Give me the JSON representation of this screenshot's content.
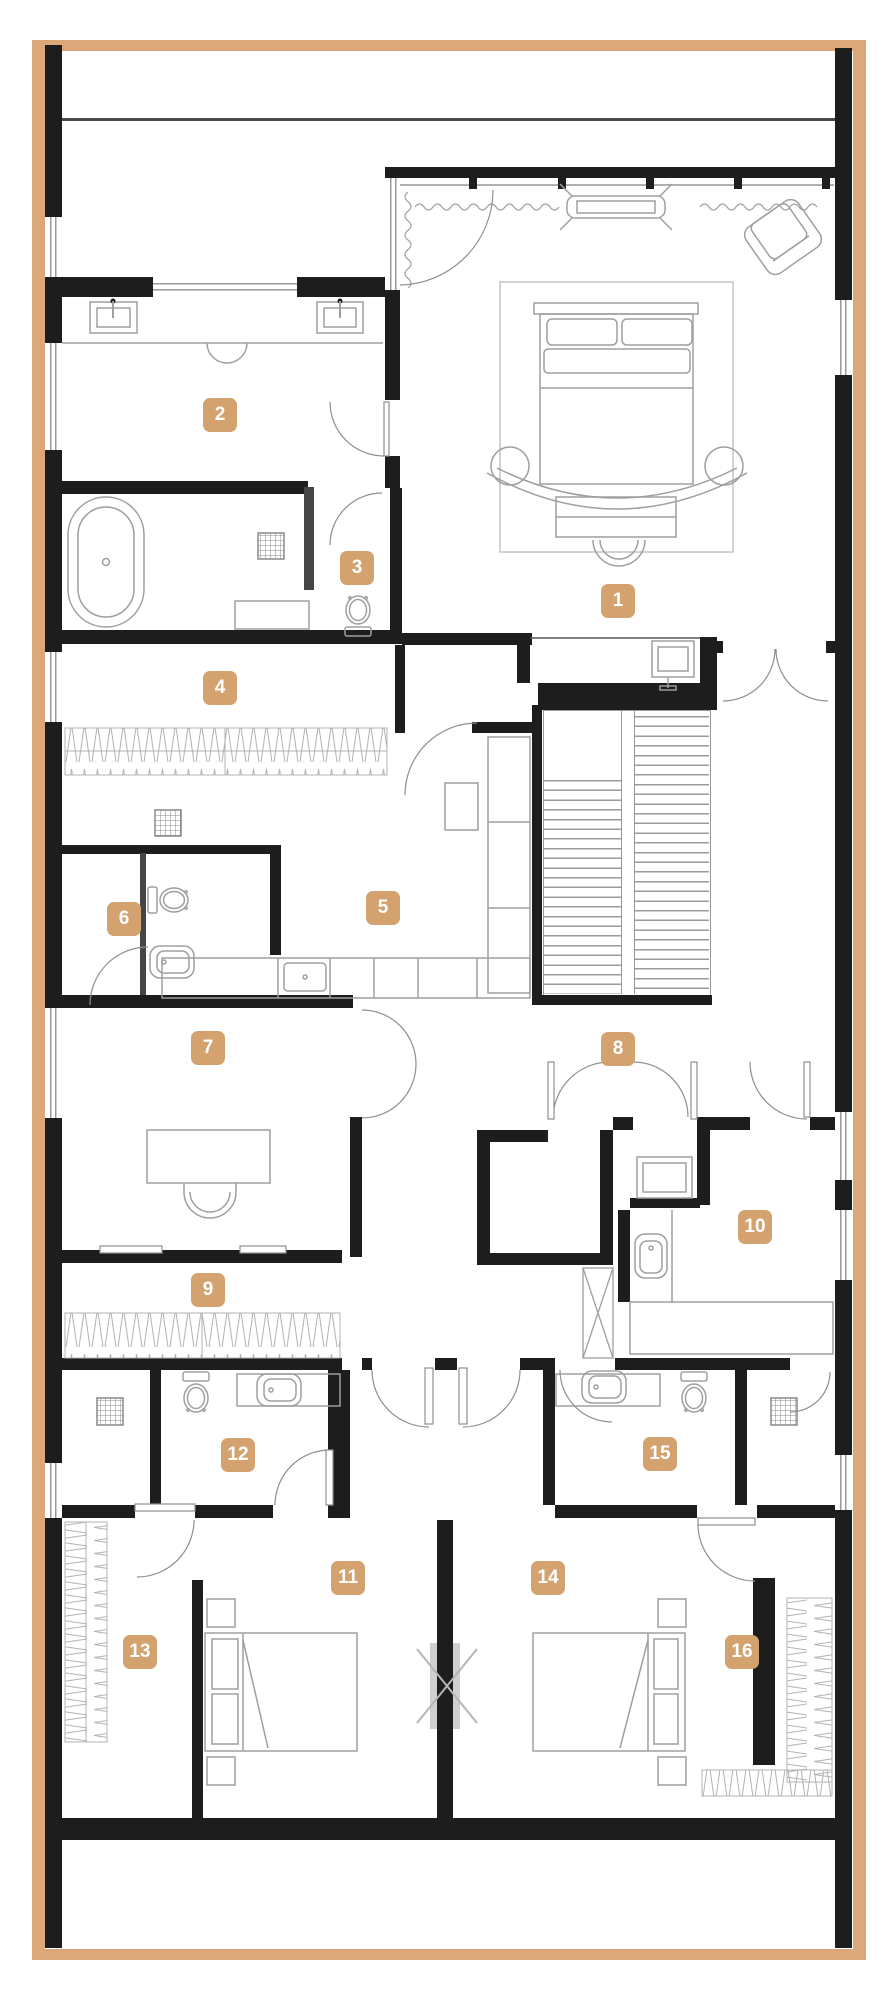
{
  "plan": {
    "title": "apartment-floor-plan",
    "rooms": [
      "1",
      "2",
      "3",
      "4",
      "5",
      "6",
      "7",
      "8",
      "9",
      "10",
      "11",
      "12",
      "13",
      "14",
      "15",
      "16"
    ]
  },
  "colors": {
    "accent_badge": "#d3a26f",
    "frame_border": "#dca87a",
    "wall": "#1d1d1d",
    "furniture_line": "#9f9f9f",
    "terrace_line": "#4a4a4a",
    "background": "#ffffff"
  }
}
